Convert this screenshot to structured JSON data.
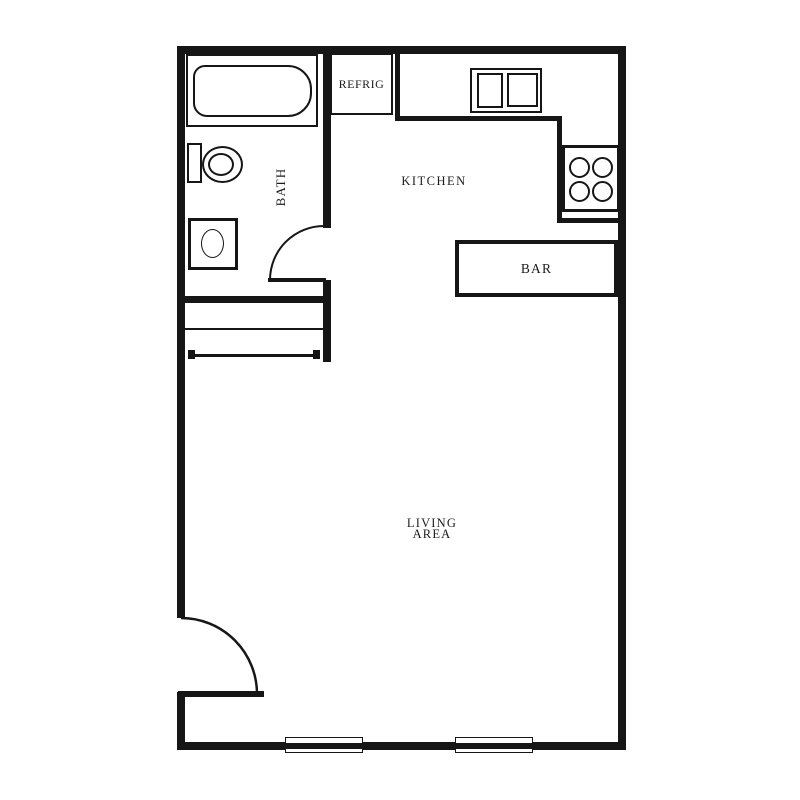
{
  "title": "Studio apartment floor plan",
  "colors": {
    "line": "#161616",
    "background": "#ffffff",
    "text": "#1c1c1c"
  },
  "rooms": {
    "bath": "BATH",
    "kitchen": "KITCHEN",
    "living_line1": "LIVING",
    "living_line2": "AREA",
    "bar": "BAR"
  },
  "appliances": {
    "refrigerator": "REFRIG"
  },
  "icons": [
    "bathtub-icon",
    "toilet-icon",
    "vanity-sink-icon",
    "double-sink-icon",
    "stove-burners-icon",
    "closet-shelf-icon",
    "door-swing-icon",
    "window-icon"
  ]
}
